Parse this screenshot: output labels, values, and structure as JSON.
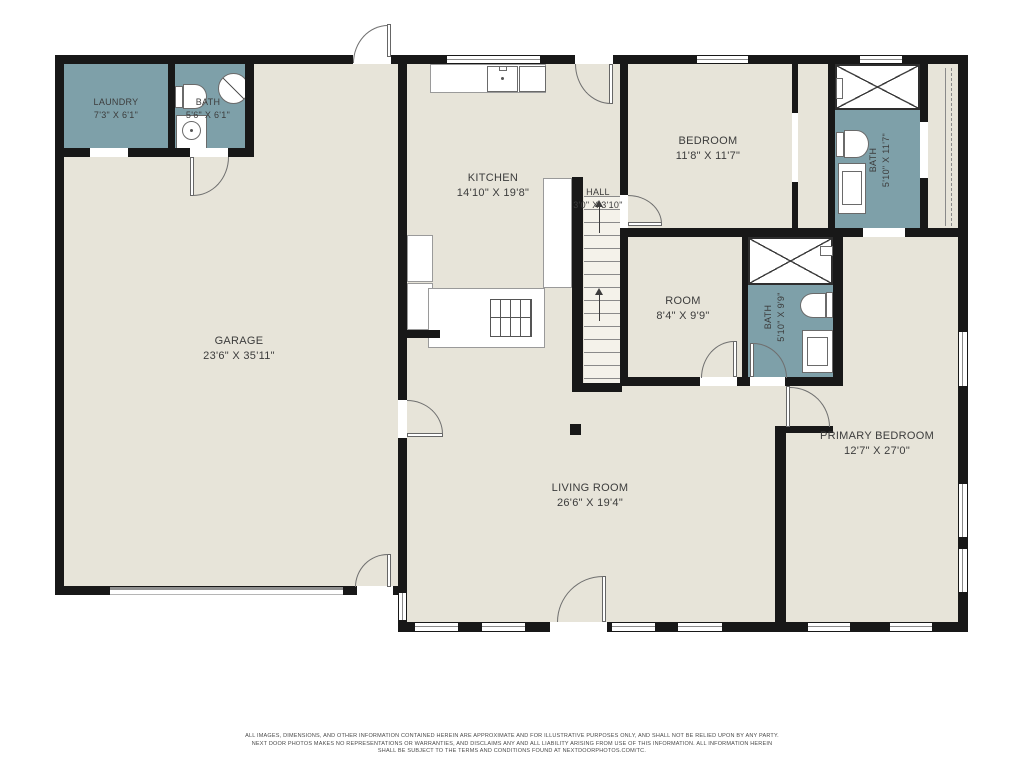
{
  "plan": {
    "rooms": {
      "laundry": {
        "name": "LAUNDRY",
        "dims": "7'3\" X 6'1\""
      },
      "bath_laundry": {
        "name": "BATH",
        "dims": "5'6\" X 6'1\""
      },
      "kitchen": {
        "name": "KITCHEN",
        "dims": "14'10\" X 19'8\""
      },
      "hall": {
        "name": "HALL",
        "dims": "3'0\" X 3'10\""
      },
      "bedroom": {
        "name": "BEDROOM",
        "dims": "11'8\" X 11'7\""
      },
      "bath_upper": {
        "name": "BATH",
        "dims": "5'10\" X 11'7\""
      },
      "room": {
        "name": "ROOM",
        "dims": "8'4\" X 9'9\""
      },
      "bath_middle": {
        "name": "BATH",
        "dims": "5'10\" X 9'9\""
      },
      "garage": {
        "name": "GARAGE",
        "dims": "23'6\" X 35'11\""
      },
      "living_room": {
        "name": "LIVING ROOM",
        "dims": "26'6\" X 19'4\""
      },
      "primary_bedroom": {
        "name": "PRIMARY BEDROOM",
        "dims": "12'7\" X 27'0\""
      }
    },
    "colors": {
      "wall": "#181818",
      "floor": "#E7E4D9",
      "wet_room": "#7EA0A9",
      "fixture_outline": "#6a6a6a",
      "label_text": "#3c3c3c"
    }
  },
  "disclaimer": {
    "line1": "ALL IMAGES, DIMENSIONS, AND OTHER INFORMATION CONTAINED HEREIN ARE APPROXIMATE AND FOR ILLUSTRATIVE PURPOSES ONLY, AND SHALL NOT BE RELIED UPON BY ANY PARTY.",
    "line2": "NEXT DOOR PHOTOS MAKES NO REPRESENTATIONS OR WARRANTIES, AND DISCLAIMS ANY AND ALL LIABILITY ARISING FROM USE OF THIS INFORMATION. ALL INFORMATION HEREIN",
    "line3": "SHALL BE SUBJECT TO THE TERMS AND CONDITIONS FOUND AT NEXTDOORPHOTOS.COM/TC."
  }
}
